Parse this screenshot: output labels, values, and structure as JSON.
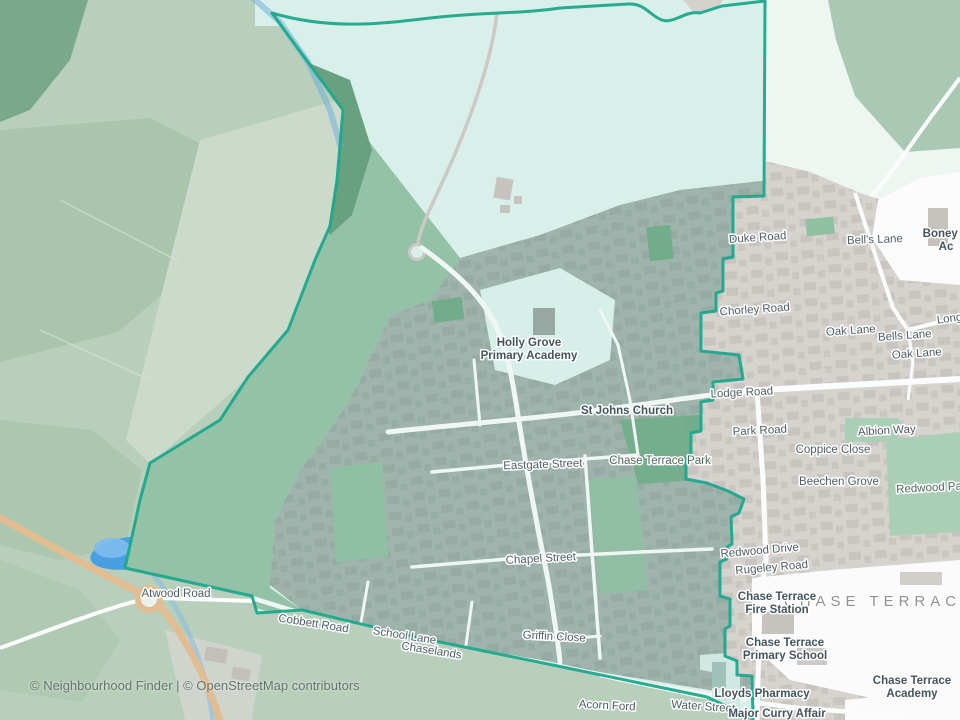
{
  "map": {
    "attribution": "© Neighbourhood Finder | © OpenStreetMap contributors",
    "colors": {
      "boundary_teal": "#1ca88c",
      "inside_open_teal": "#d9efe9",
      "inside_urban": "#9fb4ac",
      "outside_urban_gray": "#d6d3cf",
      "forest_green": "#b8cfbb",
      "park_green": "#74ae8c",
      "water_blue": "#4a9fe0",
      "main_road_orange": "#e3bd92",
      "road_white": "#f6faf8"
    },
    "labels": [
      {
        "text": "Atwood Road",
        "x": 176,
        "y": 597,
        "rot": 0,
        "cls": "road"
      },
      {
        "text": "Cobbett Road",
        "x": 313,
        "y": 627,
        "rot": 9,
        "cls": "road"
      },
      {
        "text": "School Lane",
        "x": 404,
        "y": 639,
        "rot": 9,
        "cls": "road"
      },
      {
        "text": "Chaselands",
        "x": 431,
        "y": 654,
        "rot": 9,
        "cls": "road"
      },
      {
        "text": "Griffin Close",
        "x": 554,
        "y": 640,
        "rot": 3,
        "cls": "road"
      },
      {
        "text": "Chapel Street",
        "x": 541,
        "y": 562,
        "rot": -3,
        "cls": "road"
      },
      {
        "text": "Eastgate Street",
        "x": 543,
        "y": 468,
        "rot": -2,
        "cls": "road"
      },
      {
        "text": "Water Street",
        "x": 703,
        "y": 710,
        "rot": 4,
        "cls": "road"
      },
      {
        "text": "Acorn Ford",
        "x": 607,
        "y": 709,
        "rot": 3,
        "cls": "road"
      },
      {
        "text": "Duke Road",
        "x": 758,
        "y": 241,
        "rot": -4,
        "cls": "road"
      },
      {
        "text": "Chorley Road",
        "x": 755,
        "y": 313,
        "rot": -4,
        "cls": "road"
      },
      {
        "text": "Lodge Road",
        "x": 742,
        "y": 396,
        "rot": -3,
        "cls": "road"
      },
      {
        "text": "Park Road",
        "x": 760,
        "y": 434,
        "rot": -3,
        "cls": "road"
      },
      {
        "text": "Oak Lane",
        "x": 851,
        "y": 334,
        "rot": -4,
        "cls": "road"
      },
      {
        "text": "Bells Lane",
        "x": 905,
        "y": 339,
        "rot": -4,
        "cls": "road"
      },
      {
        "text": "Oak Lane",
        "x": 917,
        "y": 357,
        "rot": -4,
        "cls": "road"
      },
      {
        "text": "Bell's Lane",
        "x": 875,
        "y": 243,
        "rot": -2,
        "cls": "road"
      },
      {
        "text": "Long",
        "x": 950,
        "y": 322,
        "rot": -8,
        "cls": "road"
      },
      {
        "text": "Albion Way",
        "x": 887,
        "y": 434,
        "rot": -3,
        "cls": "road"
      },
      {
        "text": "Coppice Close",
        "x": 833,
        "y": 453,
        "rot": 0,
        "cls": "road"
      },
      {
        "text": "Beechen Grove",
        "x": 839,
        "y": 485,
        "rot": 0,
        "cls": "road"
      },
      {
        "text": "Redwood Park",
        "x": 934,
        "y": 491,
        "rot": -3,
        "cls": "park"
      },
      {
        "text": "Redwood Drive",
        "x": 760,
        "y": 554,
        "rot": -5,
        "cls": "road"
      },
      {
        "text": "Rugeley Road",
        "x": 772,
        "y": 571,
        "rot": -5,
        "cls": "road"
      },
      {
        "text": "Chase Terrace Park",
        "x": 660,
        "y": 464,
        "rot": 0,
        "cls": "park"
      },
      {
        "text": "St Johns Church",
        "x": 627,
        "y": 414,
        "rot": 0,
        "cls": "poi"
      },
      {
        "text": "Lloyds Pharmacy",
        "x": 762,
        "y": 697,
        "rot": 0,
        "cls": "poi"
      },
      {
        "text": "Major Curry Affair",
        "x": 777,
        "y": 717,
        "rot": 0,
        "cls": "poi"
      },
      {
        "text": "CHASE TERRACE",
        "x": 880,
        "y": 606,
        "rot": 0,
        "cls": "area"
      }
    ],
    "poi_labels": [
      {
        "lines": [
          "Holly Grove",
          "Primary Academy"
        ],
        "x": 529,
        "y": 346,
        "lh": 13
      },
      {
        "lines": [
          "Chase Terrace",
          "Fire Station"
        ],
        "x": 777,
        "y": 600,
        "lh": 13
      },
      {
        "lines": [
          "Chase Terrace",
          "Primary School"
        ],
        "x": 785,
        "y": 646,
        "lh": 13
      },
      {
        "lines": [
          "Chase Terrace",
          "Academy"
        ],
        "x": 912,
        "y": 684,
        "lh": 13
      },
      {
        "lines": [
          "Boney H",
          "Ac"
        ],
        "x": 946,
        "y": 237,
        "lh": 13
      }
    ]
  }
}
